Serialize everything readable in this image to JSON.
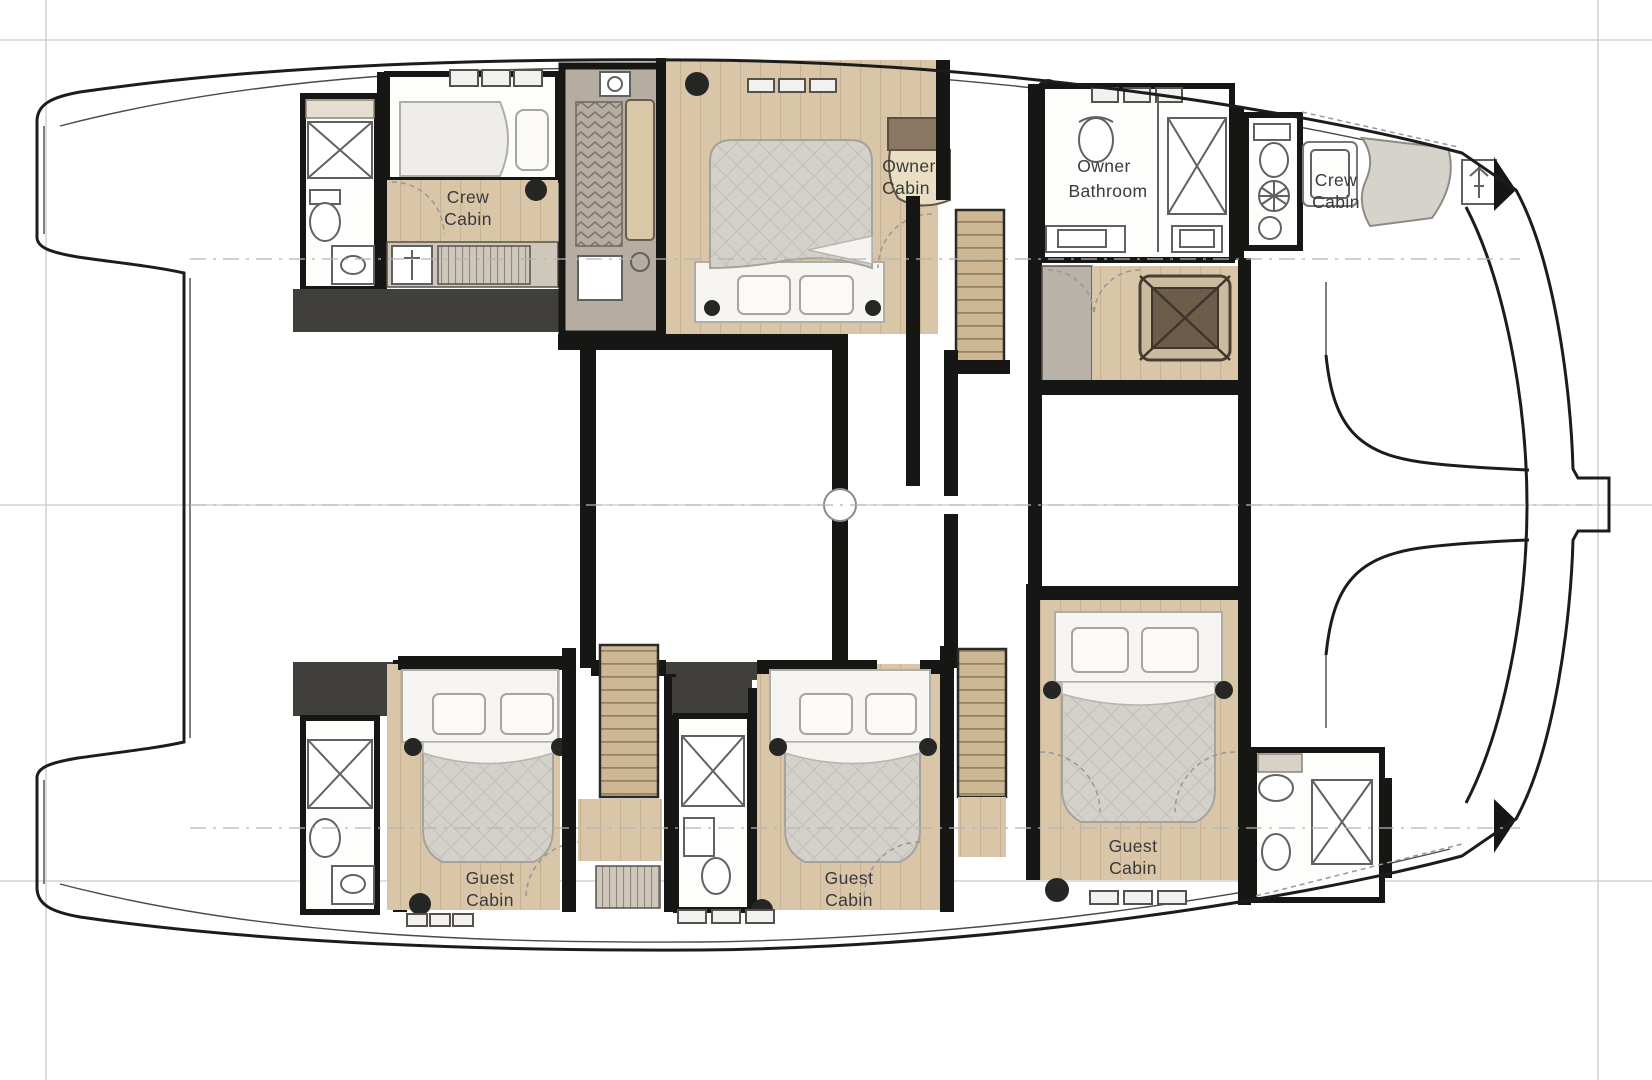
{
  "rooms": {
    "crew_cabin_aft": {
      "line1": "Crew",
      "line2": "Cabin"
    },
    "owner_cabin": {
      "line1": "Owner",
      "line2": "Cabin"
    },
    "owner_bathroom": {
      "line1": "Owner",
      "line2": "Bathroom"
    },
    "crew_cabin_fore": {
      "line1": "Crew",
      "line2": "Cabin"
    },
    "guest_cabin_aft": {
      "line1": "Guest",
      "line2": "Cabin"
    },
    "guest_cabin_mid": {
      "line1": "Guest",
      "line2": "Cabin"
    },
    "guest_cabin_fore": {
      "line1": "Guest",
      "line2": "Cabin"
    }
  },
  "colors": {
    "background": "#ffffff",
    "hull_outline": "#1c1c1c",
    "wall": "#161615",
    "charcoal": "#413f3c",
    "wood_floor": "#d9c6a9",
    "wood_line": "#c8b291",
    "stair_wood": "#cdb795",
    "stair_line": "#95825f",
    "closet_fill": "#cfc8ba",
    "closet_line": "#8f877b",
    "tech_room": "#b5ada2",
    "chevron_line": "#7d756a",
    "quilt_fill": "#d4d1cb",
    "quilt_line": "#c3c0ba",
    "bed_white": "#f6f5f2",
    "pillow": "#fbfaf9",
    "fixture_line": "#616161",
    "bathroom_white": "#fdfdfc",
    "grid_line": "#cbcbcb",
    "centerline": "#b5b5b5",
    "label_text": "#3a3a3a",
    "table_brown": "#6e5c4b",
    "cabinet_brown": "#8b7663",
    "desk_cream": "#eadfc4",
    "cushion_gray": "#d6d3cc",
    "door_arc": "#979797"
  }
}
